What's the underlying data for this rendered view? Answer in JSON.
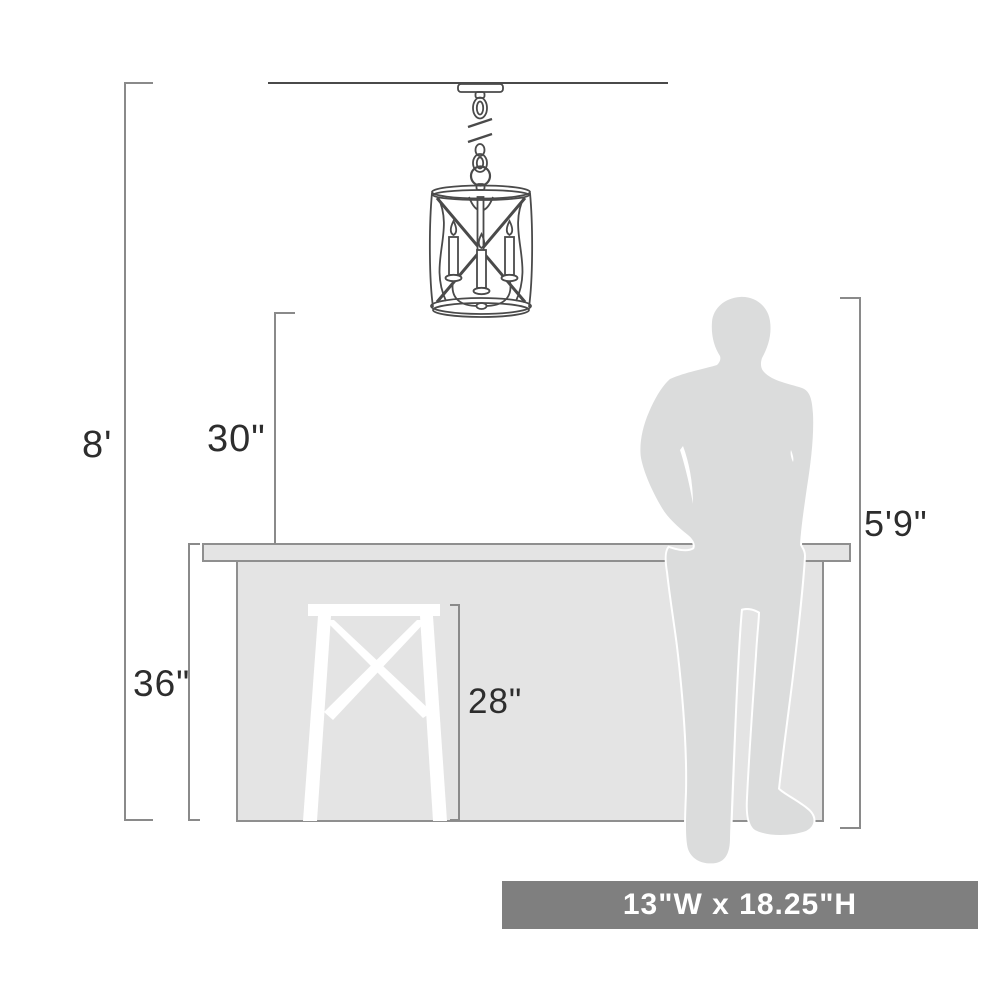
{
  "diagram": {
    "type": "product-dimension-diagram",
    "subject": "cage pendant light over kitchen island with bar stool and human figure for scale",
    "labels": {
      "ceiling_height": "8'",
      "counter_to_fixture_clearance": "30\"",
      "counter_height": "36\"",
      "stool_height": "28\"",
      "person_height": "5'9\""
    },
    "banner": {
      "text": "13\"W x 18.25\"H"
    },
    "colors": {
      "background": "#ffffff",
      "dimension_line": "#8a8a8a",
      "line_art": "#4a4a4a",
      "label_text": "#2d2d2d",
      "counter_fill": "#e4e4e4",
      "person_fill": "#dbdcdc",
      "stool_fill": "#ffffff",
      "banner_fill": "#7f7f7f",
      "banner_text": "#ffffff"
    }
  }
}
